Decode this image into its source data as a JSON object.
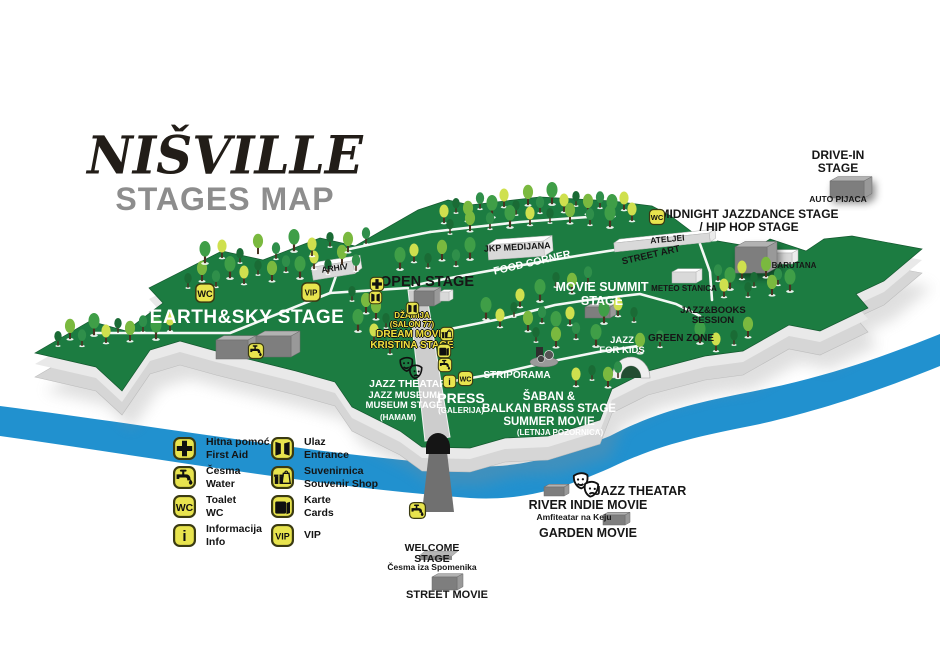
{
  "title": {
    "main": "NIŠVILLE",
    "subtitle": "STAGES MAP"
  },
  "colors": {
    "grass": "#1c7c41",
    "grass_edge": "#14592f",
    "river": "#2191cf",
    "wall": "#d6d6d6",
    "wall_light": "#e9e9e9",
    "icon_yellow": "#e8e44e",
    "label_yellow": "#f2e23c",
    "stage_front": "#7e7e7e",
    "stage_top": "#b2b2b2",
    "white_building_top": "#ffffff",
    "white_building_front": "#d9d9d9",
    "title_black": "#221d18",
    "subtitle_gray": "#8d8d8d",
    "road": "#707070"
  },
  "legend": {
    "items": [
      {
        "id": "first-aid",
        "icon": "firstaid",
        "label_sr": "Hitna pomoć",
        "label_en": "First Aid"
      },
      {
        "id": "water",
        "icon": "tap",
        "label_sr": "Česma",
        "label_en": "Water"
      },
      {
        "id": "toilet",
        "icon": "wc",
        "label_sr": "Toalet",
        "label_en": "WC"
      },
      {
        "id": "information",
        "icon": "info",
        "label_sr": "Informacija",
        "label_en": "Info"
      },
      {
        "id": "entrance",
        "icon": "entrance",
        "label_sr": "Ulaz",
        "label_en": "Entrance"
      },
      {
        "id": "souvenir-shop",
        "icon": "souvenir",
        "label_sr": "Suvenirnica",
        "label_en": "Souvenir Shop"
      },
      {
        "id": "cards",
        "icon": "cards",
        "label_sr": "Karte",
        "label_en": "Cards"
      },
      {
        "id": "vip",
        "icon": "vip",
        "label_sr": "VIP",
        "label_en": ""
      }
    ]
  },
  "map": {
    "labels": [
      {
        "id": "drive-in-stage",
        "lines": [
          "DRIVE-IN",
          "STAGE"
        ],
        "x": 838,
        "y": 149,
        "size": 12,
        "weight": 800,
        "color": "black"
      },
      {
        "id": "auto-pijaca",
        "lines": [
          "AUTO PIJACA"
        ],
        "x": 838,
        "y": 195,
        "size": 8.5,
        "weight": 700,
        "color": "black"
      },
      {
        "id": "midnight-jazzdance-stage",
        "lines": [
          "MIDNIGHT JAZZDANCE STAGE",
          "/ HIP HOP STAGE"
        ],
        "x": 749,
        "y": 208,
        "size": 12,
        "weight": 800,
        "color": "black"
      },
      {
        "id": "ateljei",
        "lines": [
          "ATELJEI"
        ],
        "x": 667,
        "y": 235,
        "size": 8.5,
        "weight": 700,
        "color": "black",
        "rotate": -5
      },
      {
        "id": "street-art",
        "lines": [
          "STREET ART"
        ],
        "x": 650,
        "y": 251,
        "size": 9.5,
        "weight": 700,
        "color": "black",
        "rotate": -13
      },
      {
        "id": "jkp-medijana",
        "lines": [
          "JKP MEDIJANA"
        ],
        "x": 517,
        "y": 243,
        "size": 9,
        "weight": 700,
        "color": "black",
        "rotate": -3
      },
      {
        "id": "food-corner",
        "lines": [
          "FOOD CORNER"
        ],
        "x": 531,
        "y": 258,
        "size": 10.5,
        "weight": 700,
        "color": "white",
        "rotate": -13
      },
      {
        "id": "arhiv",
        "lines": [
          "ARHIV"
        ],
        "x": 334,
        "y": 264,
        "size": 8.5,
        "weight": 700,
        "color": "black",
        "rotate": -8
      },
      {
        "id": "movie-summit-stage",
        "lines": [
          "MOVIE SUMMIT",
          "STAGE"
        ],
        "x": 602,
        "y": 281,
        "size": 12.5,
        "weight": 700,
        "color": "white"
      },
      {
        "id": "meteo-stanica",
        "lines": [
          "METEO STANICA"
        ],
        "x": 684,
        "y": 285,
        "size": 8,
        "weight": 700,
        "color": "black"
      },
      {
        "id": "barutana",
        "lines": [
          "BARUTANA"
        ],
        "x": 794,
        "y": 262,
        "size": 8,
        "weight": 700,
        "color": "black"
      },
      {
        "id": "jazz-books-session",
        "lines": [
          "JAZZ&BOOKS",
          "SESSION"
        ],
        "x": 713,
        "y": 306,
        "size": 9.5,
        "weight": 800,
        "color": "black"
      },
      {
        "id": "green-zone",
        "lines": [
          "GREEN ZONE"
        ],
        "x": 681,
        "y": 334,
        "size": 10,
        "weight": 800,
        "color": "black"
      },
      {
        "id": "jazz-for-kids",
        "lines": [
          "JAZZ",
          "FOR KIDS"
        ],
        "x": 622,
        "y": 336,
        "size": 9.5,
        "weight": 800,
        "color": "white"
      },
      {
        "id": "earth-sky-stage",
        "lines": [
          "EARTH&SKY STAGE"
        ],
        "x": 247,
        "y": 308,
        "size": 19,
        "weight": 600,
        "color": "white",
        "spacing": 0.5
      },
      {
        "id": "open-stage",
        "lines": [
          "OPEN STAGE"
        ],
        "x": 427,
        "y": 275,
        "size": 14.5,
        "weight": 800,
        "color": "black"
      },
      {
        "id": "dzamija-salon-77",
        "lines": [
          "DŽAMIJA",
          "(SALON 77)"
        ],
        "x": 412,
        "y": 312,
        "size": 8,
        "weight": 800,
        "color": "yellow"
      },
      {
        "id": "dream-movie-kristina-stage",
        "lines": [
          "DREAM MOVIE",
          "KRISTINA STAGE"
        ],
        "x": 412,
        "y": 330,
        "size": 10,
        "weight": 800,
        "color": "yellow"
      },
      {
        "id": "jazz-theatar",
        "lines": [
          "JAZZ THEATAR"
        ],
        "x": 408,
        "y": 379,
        "size": 10.5,
        "weight": 800,
        "color": "white"
      },
      {
        "id": "jazz-museum-museum-stage",
        "lines": [
          "JAZZ MUSEUM/",
          "MUSEUM STAGE"
        ],
        "x": 404,
        "y": 391,
        "size": 9.5,
        "weight": 800,
        "color": "white"
      },
      {
        "id": "hamam",
        "lines": [
          "(HAMAM)"
        ],
        "x": 398,
        "y": 414,
        "size": 8,
        "weight": 800,
        "color": "white"
      },
      {
        "id": "press",
        "lines": [
          "PRESS"
        ],
        "x": 461,
        "y": 391,
        "size": 14,
        "weight": 800,
        "color": "white"
      },
      {
        "id": "galerija",
        "lines": [
          "(GALERIJA)"
        ],
        "x": 461,
        "y": 407,
        "size": 8,
        "weight": 700,
        "color": "white"
      },
      {
        "id": "striporama",
        "lines": [
          "STRIPORAMA"
        ],
        "x": 517,
        "y": 371,
        "size": 10,
        "weight": 800,
        "color": "white"
      },
      {
        "id": "saban-balkan-brass-stage",
        "lines": [
          "ŠABAN &",
          "BALKAN BRASS STAGE",
          "SUMMER MOVIE"
        ],
        "x": 549,
        "y": 391,
        "size": 11.5,
        "weight": 800,
        "color": "white"
      },
      {
        "id": "letnja-pozornica",
        "lines": [
          "(LETNJA POZORNICA)"
        ],
        "x": 560,
        "y": 429,
        "size": 8,
        "weight": 700,
        "color": "white"
      },
      {
        "id": "welcome-stage",
        "lines": [
          "WELCOME",
          "STAGE"
        ],
        "x": 432,
        "y": 543,
        "size": 10.5,
        "weight": 800,
        "color": "black"
      },
      {
        "id": "cesma-iza-spomenika",
        "lines": [
          "Česma iza Spomenika"
        ],
        "x": 432,
        "y": 563,
        "size": 8.5,
        "weight": 700,
        "color": "black"
      },
      {
        "id": "street-movie",
        "lines": [
          "STREET MOVIE"
        ],
        "x": 447,
        "y": 590,
        "size": 11,
        "weight": 800,
        "color": "black"
      },
      {
        "id": "jazz-theatar-riverside",
        "lines": [
          "JAZZ THEATAR"
        ],
        "x": 640,
        "y": 485,
        "size": 12.5,
        "weight": 800,
        "color": "black"
      },
      {
        "id": "river-indie-movie",
        "lines": [
          "RIVER INDIE MOVIE"
        ],
        "x": 588,
        "y": 499,
        "size": 12.5,
        "weight": 800,
        "color": "black"
      },
      {
        "id": "amfiteatar-na-keju",
        "lines": [
          "Amfiteatar na Keju"
        ],
        "x": 574,
        "y": 513,
        "size": 8.5,
        "weight": 800,
        "color": "black"
      },
      {
        "id": "garden-movie",
        "lines": [
          "GARDEN MOVIE"
        ],
        "x": 588,
        "y": 527,
        "size": 12.5,
        "weight": 800,
        "color": "black"
      }
    ],
    "icons": [
      {
        "type": "wc",
        "x": 205,
        "y": 293,
        "s": 22
      },
      {
        "type": "vip",
        "x": 311,
        "y": 292,
        "s": 22
      },
      {
        "type": "firstaid",
        "x": 377,
        "y": 284,
        "s": 16
      },
      {
        "type": "entrance",
        "x": 375,
        "y": 297,
        "s": 15
      },
      {
        "type": "entrance",
        "x": 412,
        "y": 308,
        "s": 15
      },
      {
        "type": "souvenir",
        "x": 447,
        "y": 334,
        "s": 16
      },
      {
        "type": "cards",
        "x": 444,
        "y": 351,
        "s": 16
      },
      {
        "type": "tap",
        "x": 445,
        "y": 365,
        "s": 16
      },
      {
        "type": "info",
        "x": 449,
        "y": 381,
        "s": 15
      },
      {
        "type": "wc",
        "x": 465,
        "y": 378,
        "s": 17
      },
      {
        "type": "wc",
        "x": 657,
        "y": 217,
        "s": 18
      },
      {
        "type": "tap",
        "x": 256,
        "y": 351,
        "s": 18
      },
      {
        "type": "tap",
        "x": 417,
        "y": 510,
        "s": 19
      },
      {
        "type": "masks",
        "variant": "outline",
        "x": 411,
        "y": 369,
        "s": 30
      },
      {
        "type": "masks",
        "variant": "filled",
        "x": 586,
        "y": 486,
        "s": 34
      }
    ],
    "structures": [
      {
        "id": "arhiv-building",
        "type": "white",
        "x": 312,
        "y": 264,
        "w": 42,
        "h": 13,
        "d": 8,
        "rot": -9
      },
      {
        "id": "jkp-medijana-building",
        "type": "white",
        "x": 488,
        "y": 243,
        "w": 56,
        "h": 15,
        "d": 9,
        "rot": -4
      },
      {
        "id": "ateljei-building",
        "type": "white",
        "x": 614,
        "y": 238,
        "w": 96,
        "h": 9,
        "d": 6,
        "rot": -6
      },
      {
        "id": "meteo-stanica-building",
        "type": "white",
        "x": 672,
        "y": 272,
        "w": 24,
        "h": 11,
        "d": 6
      },
      {
        "id": "barutana-building",
        "type": "white",
        "x": 768,
        "y": 253,
        "w": 24,
        "h": 11,
        "d": 6
      },
      {
        "id": "open-stage-building",
        "type": "stage",
        "x": 414,
        "y": 291,
        "w": 20,
        "h": 15,
        "d": 7
      },
      {
        "id": "open-stage-annex",
        "type": "white",
        "x": 440,
        "y": 292,
        "w": 9,
        "h": 9,
        "d": 4
      },
      {
        "id": "movie-summit-building",
        "type": "stage",
        "x": 585,
        "y": 307,
        "w": 25,
        "h": 11,
        "d": 6
      },
      {
        "id": "earth-sky-building-1",
        "type": "stage",
        "x": 216,
        "y": 340,
        "w": 32,
        "h": 19,
        "d": 8
      },
      {
        "id": "earth-sky-building-2",
        "type": "stage",
        "x": 256,
        "y": 336,
        "w": 35,
        "h": 21,
        "d": 9
      },
      {
        "id": "midnight-stage-building",
        "type": "stage",
        "x": 735,
        "y": 247,
        "w": 32,
        "h": 26,
        "d": 10,
        "shadow": true
      },
      {
        "id": "drive-in-stage-building",
        "type": "stage",
        "x": 830,
        "y": 181,
        "w": 34,
        "h": 17,
        "d": 8,
        "shadow": true
      },
      {
        "id": "street-movie-building",
        "type": "stage",
        "x": 432,
        "y": 577,
        "w": 25,
        "h": 13,
        "d": 6
      },
      {
        "id": "river-indie-building",
        "type": "stage",
        "x": 544,
        "y": 487,
        "w": 20,
        "h": 9,
        "d": 5
      },
      {
        "id": "garden-movie-building",
        "type": "stage",
        "x": 603,
        "y": 515,
        "w": 22,
        "h": 10,
        "d": 5
      },
      {
        "id": "welcome-stage-platform",
        "type": "platform",
        "x": 419,
        "y": 551,
        "w": 33,
        "h": 4,
        "d": 6
      }
    ]
  }
}
